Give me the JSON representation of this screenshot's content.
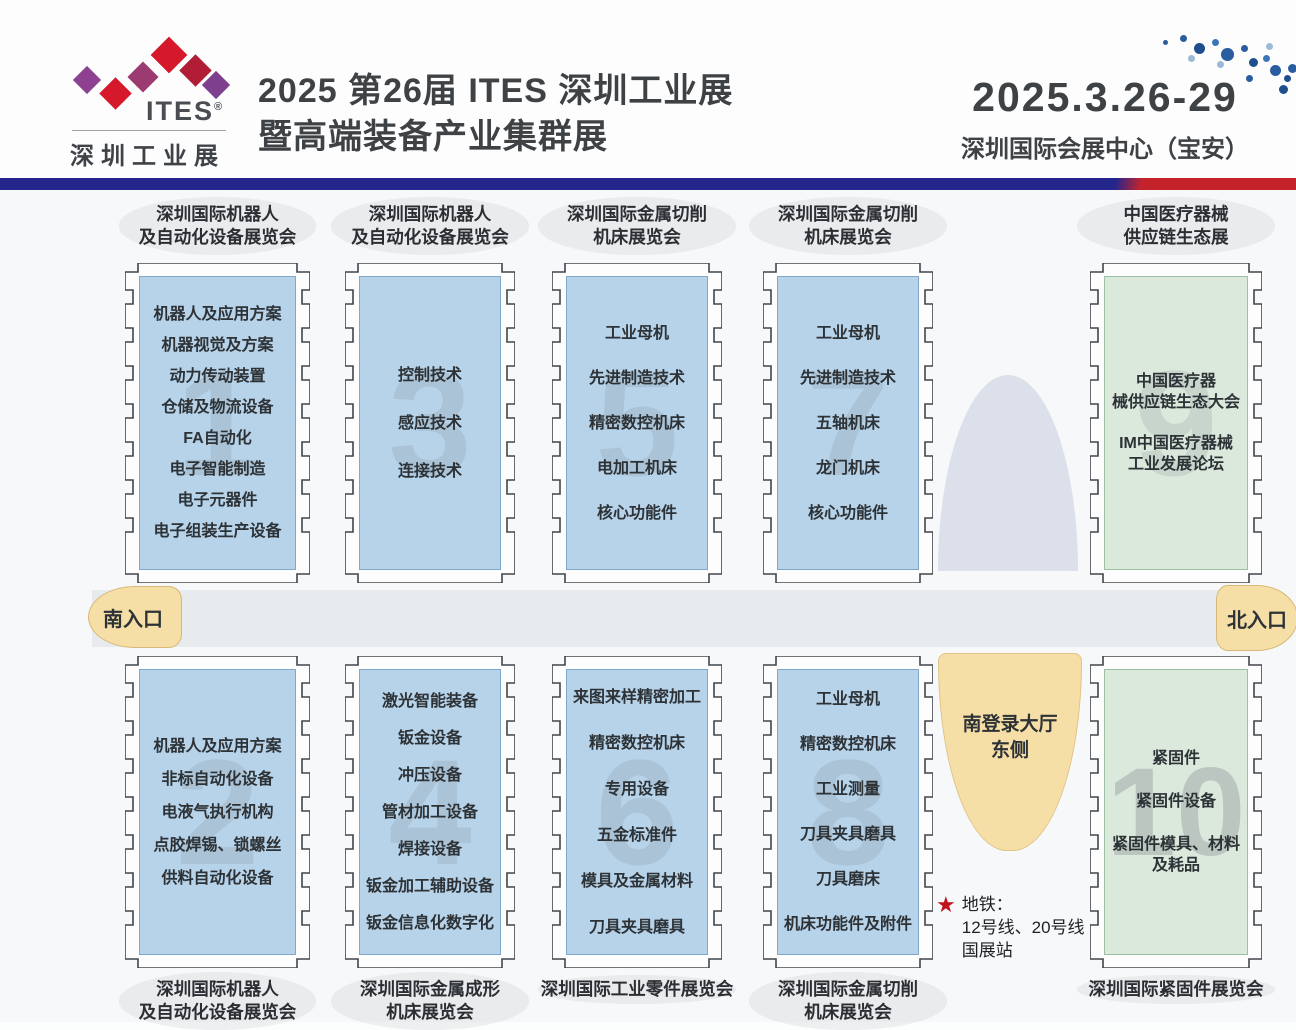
{
  "header": {
    "logo": {
      "brand": "ITES",
      "reg": "®",
      "subtitle": "深圳工业展"
    },
    "title_line1": "2025 第26届 ITES 深圳工业展",
    "title_line2": "暨高端装备产业集群展",
    "date": "2025.3.26-29",
    "venue": "深圳国际会展中心（宝安）"
  },
  "map": {
    "south_entrance": "南入口",
    "north_entrance": "北入口",
    "south_lobby_note": "南登录大厅\n东侧",
    "metro_note": "地铁：\n12号线、20号线\n国展站",
    "halls": [
      {
        "number": "1",
        "theme": "blue",
        "label_position": "top",
        "label": "深圳国际机器人\n及自动化设备展览会",
        "items": [
          "机器人及应用方案",
          "机器视觉及方案",
          "动力传动装置",
          "仓储及物流设备",
          "FA自动化",
          "电子智能制造",
          "电子元器件",
          "电子组装生产设备"
        ]
      },
      {
        "number": "3",
        "theme": "blue",
        "label_position": "top",
        "label": "深圳国际机器人\n及自动化设备展览会",
        "items": [
          "控制技术",
          "感应技术",
          "连接技术"
        ]
      },
      {
        "number": "5",
        "theme": "blue",
        "label_position": "top",
        "label": "深圳国际金属切削\n机床展览会",
        "items": [
          "工业母机",
          "先进制造技术",
          "精密数控机床",
          "电加工机床",
          "核心功能件"
        ]
      },
      {
        "number": "7",
        "theme": "blue",
        "label_position": "top",
        "label": "深圳国际金属切削\n机床展览会",
        "items": [
          "工业母机",
          "先进制造技术",
          "五轴机床",
          "龙门机床",
          "核心功能件"
        ]
      },
      {
        "number": "9",
        "theme": "green",
        "label_position": "top",
        "label": "中国医疗器械\n供应链生态展",
        "items": [
          "中国医疗器\n械供应链生态大会",
          "IM中国医疗器械\n工业发展论坛"
        ]
      },
      {
        "number": "2",
        "theme": "blue",
        "label_position": "bottom",
        "label": "深圳国际机器人\n及自动化设备展览会",
        "items": [
          "机器人及应用方案",
          "非标自动化设备",
          "电液气执行机构",
          "点胶焊锡、锁螺丝",
          "供料自动化设备"
        ]
      },
      {
        "number": "4",
        "theme": "blue",
        "label_position": "bottom",
        "label": "深圳国际金属成形\n机床展览会",
        "items": [
          "激光智能装备",
          "钣金设备",
          "冲压设备",
          "管材加工设备",
          "焊接设备",
          "钣金加工辅助设备",
          "钣金信息化数字化"
        ]
      },
      {
        "number": "6",
        "theme": "blue",
        "label_position": "bottom",
        "label": "深圳国际工业零件展览会",
        "items": [
          "来图来样精密加工",
          "精密数控机床",
          "专用设备",
          "五金标准件",
          "模具及金属材料",
          "刀具夹具磨具"
        ]
      },
      {
        "number": "8",
        "theme": "blue",
        "label_position": "bottom",
        "label": "深圳国际金属切削\n机床展览会",
        "items": [
          "工业母机",
          "精密数控机床",
          "工业测量",
          "刀具夹具磨具",
          "刀具磨床",
          "机床功能件及附件"
        ]
      },
      {
        "number": "10",
        "theme": "green",
        "label_position": "bottom",
        "label": "深圳国际紧固件展览会",
        "items": [
          "紧固件",
          "紧固件设备",
          "紧固件模具、材料\n及耗品"
        ]
      }
    ]
  },
  "colors": {
    "bar_blue": "#25268c",
    "bar_red": "#c4232b",
    "hall_blue": "#b7d3ea",
    "hall_green": "#dbe9dd",
    "entrance_tan": "#f6dfa6",
    "corridor_gray": "#e8ebee",
    "dome_gray": "#dce0ea",
    "dot_blue": "#2a5d9f",
    "logo_red": "#d6182b",
    "logo_purple": "#8e4191",
    "star_red": "#c0121f"
  }
}
